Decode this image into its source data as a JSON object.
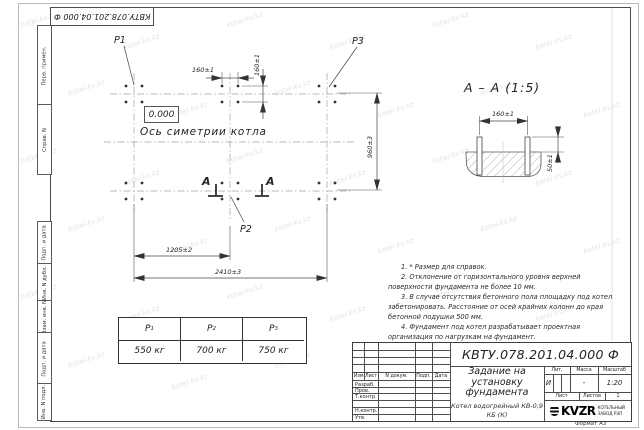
{
  "sheet": {
    "top_designation": "КВТУ.078.201.04.000  Ф",
    "format": "Формат А3",
    "watermark": "kotel-kv.kz"
  },
  "side_labels": {
    "perv_primen": "Перв. примен.",
    "sprav_n": "Справ. N",
    "podp_data_1": "Подп. и дата",
    "inv_n_dubl": "Инв. N дубл.",
    "vzam_inv_n": "Взам. инв. N",
    "podp_data_2": "Подп. и дата",
    "inv_n_podl": "Инв. N подл."
  },
  "plan": {
    "p1": "P1",
    "p2": "P2",
    "p3": "P3",
    "elevation": "0.000",
    "axis_label": "Ось симетрии котла",
    "section_letter": "А",
    "dim_bolt_horizontal": "160±1",
    "dim_bolt_vertical": "160±1",
    "dim_depth": "960±3",
    "dim_half_width": "1205±2",
    "dim_full_width": "2410±3"
  },
  "section": {
    "title": "А – А (1:5)",
    "dim_bolt_spacing": "160±1",
    "dim_protrusion": "50±1"
  },
  "notes": [
    "1. * Размер для справок.",
    "2. Отклонение от горизонтального уровня верхней поверхности фундамента не более 10 мм.",
    "3. В случае отсутствия бетонного пола площадку под котел забетонировать. Расстояние от осей крайних колонн до края бетонной подушки 500 мм.",
    "4. Фундамент под котел разрабатывает проектная организация по нагрузкам на фундамент."
  ],
  "load_table": {
    "columns": [
      {
        "symbol": "P",
        "index": "1",
        "value": "550 кг"
      },
      {
        "symbol": "P",
        "index": "2",
        "value": "700 кг"
      },
      {
        "symbol": "P",
        "index": "3",
        "value": "750 кг"
      }
    ]
  },
  "title_block": {
    "designation": "КВТУ.078.201.04.000  Ф",
    "doc_title": "Задание на установку фундамента",
    "product": "Котел водогрейный КВ-0,9 КБ (К)",
    "col_izm": "Изм.Лист",
    "col_doc": "N докум.",
    "col_podp": "Подп.",
    "col_data": "Дата",
    "row_razrab": "Разраб.",
    "row_prov": "Пров.",
    "row_tkontr": "Т.контр.",
    "row_nkontr": "Н.контр.",
    "row_utv": "Утв.",
    "lit_label": "Лит.",
    "mass_label": "Масса",
    "scale_label": "Масштаб",
    "lit_value": "И",
    "mass_value": "-",
    "scale_value": "1:20",
    "sheet_label": "Лист",
    "sheets_label": "Листов",
    "sheets_value": "1",
    "logo": "KVZR",
    "org_line1": "КОТЕЛЬНЫЙ",
    "org_line2": "ЗАВОД РЭП"
  }
}
